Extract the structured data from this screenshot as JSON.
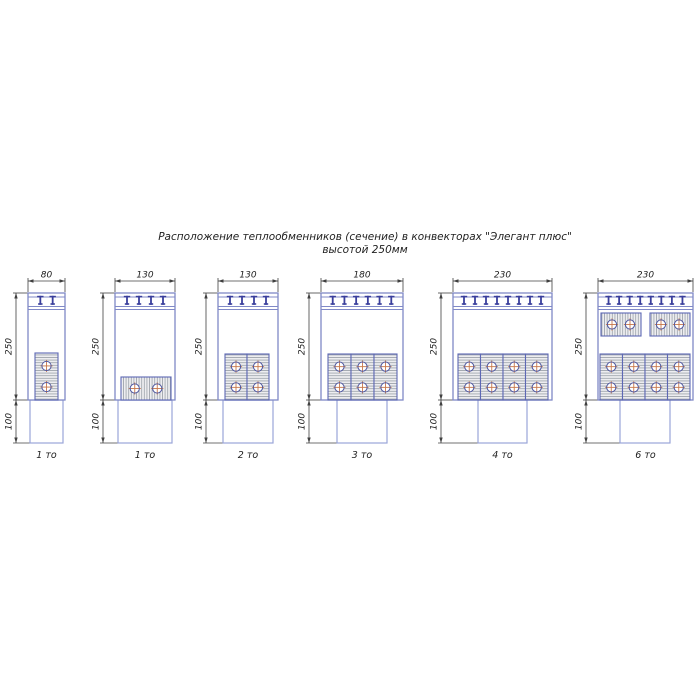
{
  "title": {
    "line1": "Расположение теплообменников (сечение) в конвекторах \"Элегант плюс\"",
    "line2": "высотой 250мм"
  },
  "colors": {
    "body_stroke": "#8089c7",
    "band_line": "#8089c7",
    "tooth": "#3a3f9c",
    "block_stroke": "#5d68b4",
    "block_fill": "#ededf0",
    "hatch": "#9aa0a8",
    "circle_stroke": "#4f579f",
    "center_mark": "#c8784b",
    "pipe_stroke": "#9aa5d8",
    "dim": "#404040",
    "text": "#1d1d1d"
  },
  "layout": {
    "body_top": 293,
    "body_h": 107,
    "pipe_h": 43,
    "dim_y": 281,
    "caption_y": 458,
    "dim_offset": 12
  },
  "diagrams": [
    {
      "caption": "1 то",
      "width_label": "80",
      "height_label": "250",
      "pipe_height_label": "100",
      "x": 28,
      "w": 37,
      "teeth": 2,
      "pipe_x": 30,
      "pipe_w": 33,
      "blocks": [
        {
          "orient": "v",
          "x": 35,
          "y": 353,
          "w": 23,
          "h": 47,
          "circles": 2
        }
      ]
    },
    {
      "caption": "1 то",
      "width_label": "130",
      "height_label": "250",
      "pipe_height_label": "100",
      "x": 115,
      "w": 60,
      "teeth": 4,
      "pipe_x": 118,
      "pipe_w": 54,
      "blocks": [
        {
          "orient": "h",
          "x": 121,
          "y": 377,
          "w": 50,
          "h": 23,
          "circles": 2
        }
      ]
    },
    {
      "caption": "2 то",
      "width_label": "130",
      "height_label": "250",
      "pipe_height_label": "100",
      "x": 218,
      "w": 60,
      "teeth": 4,
      "pipe_x": 223,
      "pipe_w": 50,
      "blocks": [
        {
          "orient": "v",
          "x": 225,
          "y": 354,
          "w": 22,
          "h": 46,
          "circles": 2
        },
        {
          "orient": "v",
          "x": 247,
          "y": 354,
          "w": 22,
          "h": 46,
          "circles": 2
        }
      ]
    },
    {
      "caption": "3 то",
      "width_label": "180",
      "height_label": "250",
      "pipe_height_label": "100",
      "x": 321,
      "w": 82,
      "teeth": 6,
      "pipe_x": 337,
      "pipe_w": 50,
      "blocks": [
        {
          "orient": "v",
          "x": 328,
          "y": 354,
          "w": 23,
          "h": 46,
          "circles": 2
        },
        {
          "orient": "v",
          "x": 351,
          "y": 354,
          "w": 23,
          "h": 46,
          "circles": 2
        },
        {
          "orient": "v",
          "x": 374,
          "y": 354,
          "w": 23,
          "h": 46,
          "circles": 2
        }
      ]
    },
    {
      "caption": "4 то",
      "width_label": "230",
      "height_label": "250",
      "pipe_height_label": "100",
      "x": 453,
      "w": 99,
      "teeth": 8,
      "pipe_x": 478,
      "pipe_w": 49,
      "blocks": [
        {
          "orient": "v",
          "x": 458,
          "y": 354,
          "w": 22.5,
          "h": 46,
          "circles": 2
        },
        {
          "orient": "v",
          "x": 480.5,
          "y": 354,
          "w": 22.5,
          "h": 46,
          "circles": 2
        },
        {
          "orient": "v",
          "x": 503,
          "y": 354,
          "w": 22.5,
          "h": 46,
          "circles": 2
        },
        {
          "orient": "v",
          "x": 525.5,
          "y": 354,
          "w": 22.5,
          "h": 46,
          "circles": 2
        }
      ]
    },
    {
      "caption": "6 то",
      "width_label": "230",
      "height_label": "250",
      "pipe_height_label": "100",
      "x": 598,
      "w": 95,
      "teeth": 8,
      "pipe_x": 620,
      "pipe_w": 50,
      "blocks": [
        {
          "orient": "h",
          "x": 601,
          "y": 313,
          "w": 40,
          "h": 23,
          "circles": 2
        },
        {
          "orient": "h",
          "x": 650,
          "y": 313,
          "w": 40,
          "h": 23,
          "circles": 2
        },
        {
          "orient": "v",
          "x": 600,
          "y": 354,
          "w": 22.5,
          "h": 46,
          "circles": 2
        },
        {
          "orient": "v",
          "x": 622.5,
          "y": 354,
          "w": 22.5,
          "h": 46,
          "circles": 2
        },
        {
          "orient": "v",
          "x": 645,
          "y": 354,
          "w": 22.5,
          "h": 46,
          "circles": 2
        },
        {
          "orient": "v",
          "x": 667.5,
          "y": 354,
          "w": 22.5,
          "h": 46,
          "circles": 2
        }
      ]
    }
  ]
}
